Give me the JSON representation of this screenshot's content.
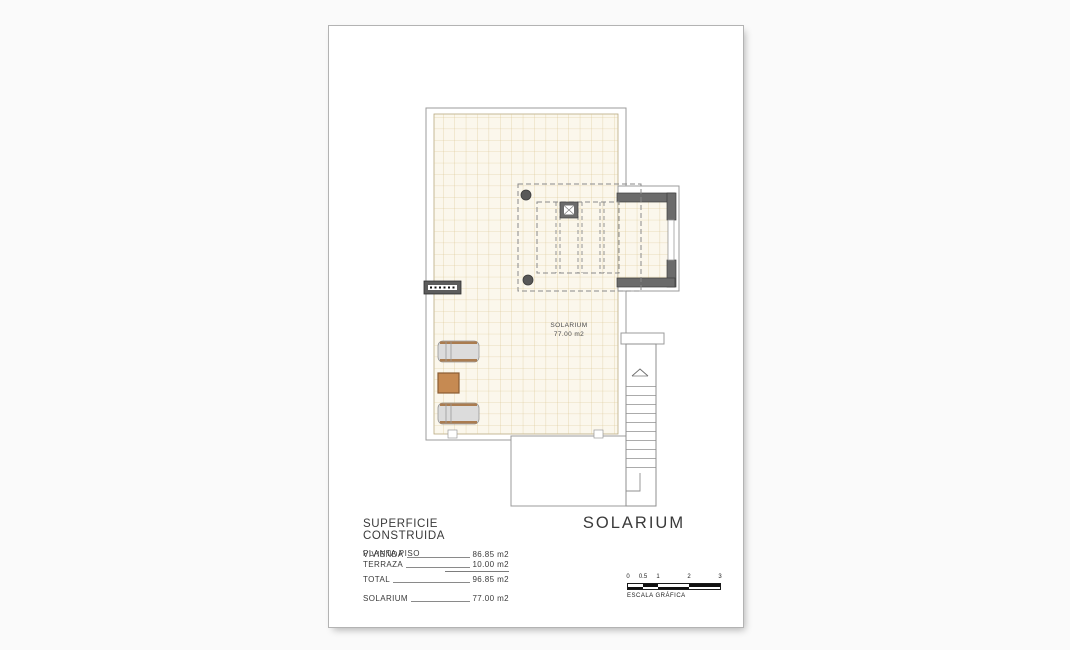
{
  "plan": {
    "room_label": {
      "line1": "SOLARIUM",
      "line2": "77.00 m2"
    },
    "elements": [
      "tiled-terrace",
      "pergola",
      "chimney",
      "columns",
      "ac-vent-grille",
      "sun-loungers",
      "side-table",
      "staircase"
    ]
  },
  "summary": {
    "title": "SUPERFICIE CONSTRUIDA",
    "subtitle": "PLANTA PISO",
    "rows": [
      {
        "label": "VIVIENDA",
        "value": "86.85 m2"
      },
      {
        "label": "TERRAZA",
        "value": "10.00 m2"
      },
      {
        "label": "TOTAL",
        "value": "96.85 m2"
      },
      {
        "label": "SOLARIUM",
        "value": "77.00 m2"
      }
    ]
  },
  "plan_title": "SOLARIUM",
  "scale_bar": {
    "ticks": [
      "0",
      "0.5",
      "1",
      "2",
      "3"
    ],
    "caption": "ESCALA GRÁFICA"
  },
  "colors": {
    "paper": "#ffffff",
    "background": "#fafafa",
    "tile_fill": "#fbf7ec",
    "tile_line": "#d9c48e",
    "wall_dark": "#6b6b6b",
    "outline": "#9b9b9b",
    "wood_table": "#c68a52",
    "lounger_trim": "#aa7c50",
    "text": "#3f3f3f"
  }
}
